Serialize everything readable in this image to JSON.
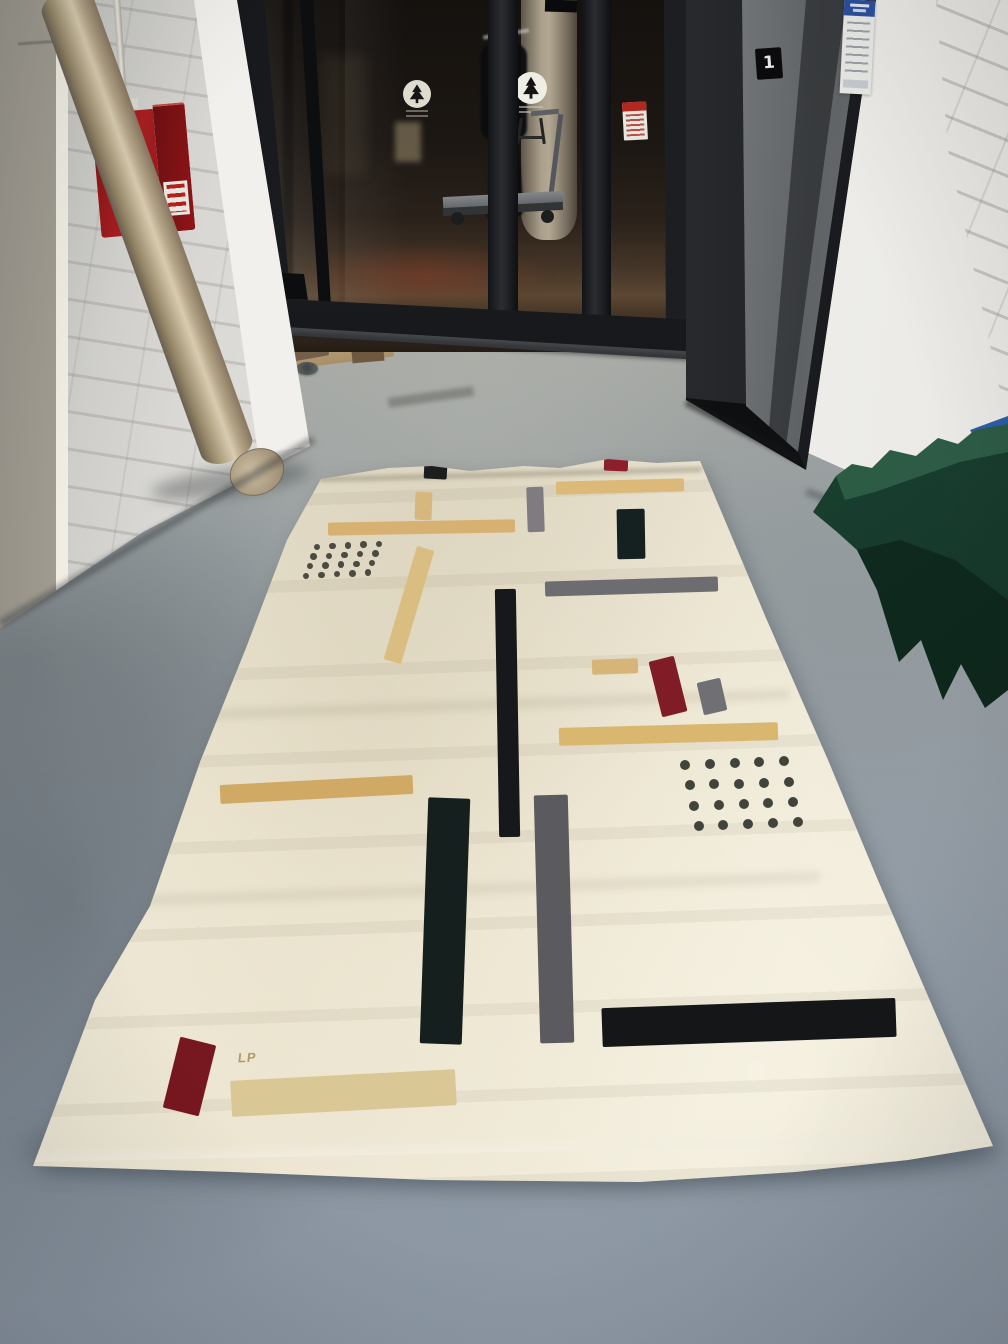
{
  "palette": {
    "floor_concrete": "#98a0a6",
    "wall_white": "#e9e8e4",
    "rug_cream": "#eae4d2",
    "rug_black": "#17181a",
    "rug_teal_black": "#142120",
    "rug_gray": "#6d6c71",
    "rug_tan": "#d6b272",
    "rug_red": "#7f1c25",
    "green_fabric": "#1d4a37",
    "elevator_steel": "#8e9195",
    "fire_cabinet_red": "#a81e1f",
    "notice_sign_blue": "#2b4f9e"
  },
  "fire_cabinet": {
    "title": "FIRE",
    "subtitle": "EXTINGUISHER"
  },
  "elevator": {
    "floor_label": "1"
  },
  "rug": {
    "monogram": "LP",
    "bars": [
      {
        "name": "bar-black-top",
        "x": 424,
        "y": 464,
        "w": 23,
        "h": 15,
        "rot": 3,
        "color": "#1c1d1f"
      },
      {
        "name": "bar-red-top",
        "x": 604,
        "y": 457,
        "w": 24,
        "h": 14,
        "rot": 2,
        "color": "#8c1f2b"
      },
      {
        "name": "bar-tan-top-right",
        "x": 556,
        "y": 480,
        "w": 128,
        "h": 13,
        "rot": -1.5,
        "color": "#dcb978"
      },
      {
        "name": "bar-gray-top-center",
        "x": 527,
        "y": 487,
        "w": 17,
        "h": 45,
        "rot": -2,
        "color": "#7f7c81"
      },
      {
        "name": "bar-tan-top-left-small",
        "x": 415,
        "y": 492,
        "w": 17,
        "h": 28,
        "rot": 2,
        "color": "#d6b87e"
      },
      {
        "name": "bar-tan-top-left-long",
        "x": 328,
        "y": 521,
        "w": 187,
        "h": 13,
        "rot": -1,
        "color": "#d6b172"
      },
      {
        "name": "bar-teal-top-right",
        "x": 617,
        "y": 509,
        "w": 28,
        "h": 50,
        "rot": -1,
        "color": "#142120"
      },
      {
        "name": "bar-tan-left-vertical",
        "x": 400,
        "y": 546,
        "w": 18,
        "h": 118,
        "rot": 16.5,
        "color": "#dabd80"
      },
      {
        "name": "bar-gray-right-long",
        "x": 545,
        "y": 579,
        "w": 173,
        "h": 15,
        "rot": -1.7,
        "color": "#6d6c71"
      },
      {
        "name": "bar-black-center-long",
        "x": 497,
        "y": 589,
        "w": 21,
        "h": 248,
        "rot": -1,
        "color": "#17181b"
      },
      {
        "name": "bar-tan-right-small",
        "x": 592,
        "y": 659,
        "w": 46,
        "h": 15,
        "rot": -2,
        "color": "#d7b478"
      },
      {
        "name": "bar-red-right",
        "x": 655,
        "y": 658,
        "w": 26,
        "h": 57,
        "rot": -14,
        "color": "#7f1c25"
      },
      {
        "name": "bar-gray-right-small",
        "x": 700,
        "y": 680,
        "w": 24,
        "h": 33,
        "rot": -13,
        "color": "#6f6f74"
      },
      {
        "name": "bar-tan-right-long",
        "x": 559,
        "y": 725,
        "w": 219,
        "h": 18,
        "rot": -1.5,
        "color": "#dab76f"
      },
      {
        "name": "bar-tan-mid-left",
        "x": 220,
        "y": 780,
        "w": 193,
        "h": 19,
        "rot": -3,
        "color": "#d0a964"
      },
      {
        "name": "bar-teal-bottom-left",
        "x": 424,
        "y": 798,
        "w": 42,
        "h": 246,
        "rot": 2,
        "color": "#141f1e"
      },
      {
        "name": "bar-gray-bottom-center",
        "x": 537,
        "y": 795,
        "w": 34,
        "h": 248,
        "rot": -1.5,
        "color": "#5b5b5f"
      },
      {
        "name": "bar-black-bottom-right",
        "x": 602,
        "y": 1003,
        "w": 294,
        "h": 39,
        "rot": -2,
        "color": "#151617"
      },
      {
        "name": "bar-red-bottom-left",
        "x": 171,
        "y": 1040,
        "w": 37,
        "h": 73,
        "rot": 14,
        "color": "#77171f"
      },
      {
        "name": "bar-tan-pale-bottom",
        "x": 231,
        "y": 1075,
        "w": 225,
        "h": 36,
        "rot": -3,
        "color": "#d9c896"
      }
    ],
    "dot_grids": [
      {
        "name": "dot-grid-left",
        "x": 317,
        "y": 547,
        "rows": 4,
        "cols": 5,
        "colDx": 15.5,
        "colDy": -0.8,
        "rowDx": -3.6,
        "rowDy": 9.6,
        "dia": 6.5,
        "color": "#4b4b41"
      },
      {
        "name": "dot-grid-right",
        "x": 685,
        "y": 765,
        "rows": 4,
        "cols": 5,
        "colDx": 24.8,
        "colDy": -0.9,
        "rowDx": 4.5,
        "rowDy": 20.3,
        "dia": 10,
        "color": "#42443b"
      }
    ]
  }
}
